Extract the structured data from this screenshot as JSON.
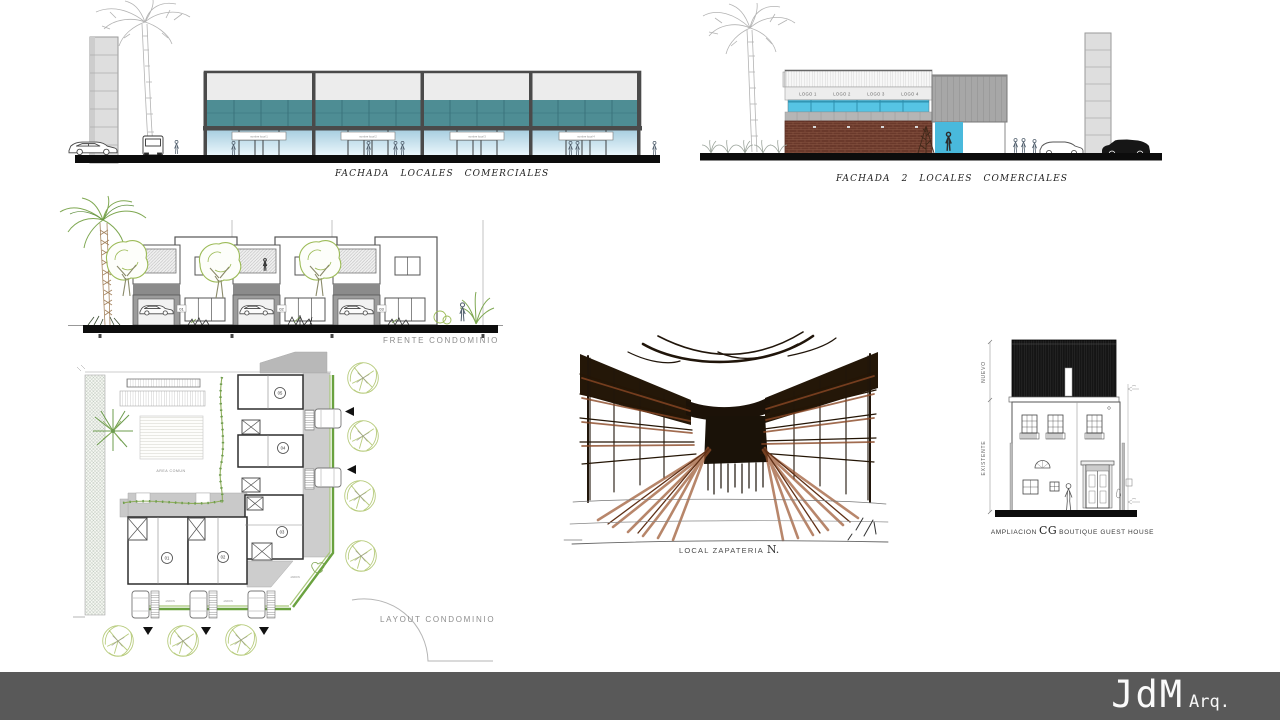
{
  "slide": {
    "footer": {
      "bar_color": "#595959",
      "brand": "JdM",
      "brand_suffix": "Arq."
    }
  },
  "fachada1": {
    "caption": "FACHADA  LOCALES  COMERCIALES",
    "signs": [
      "nombre local 1",
      "nombre local 2",
      "nombre local 3",
      "nombre local 4"
    ]
  },
  "fachada2": {
    "caption": "FACHADA 2  LOCALES  COMERCIALES",
    "logos": [
      "LOGO 1",
      "LOGO 2",
      "LOGO 3",
      "LOGO 4"
    ]
  },
  "frente": {
    "caption": "FRENTE  CONDOMINIO",
    "units": [
      "01",
      "02",
      "03"
    ]
  },
  "layout": {
    "caption": "LAYOUT  CONDOMINIO",
    "area_label": "AREA COMUN",
    "garden_label": "JARDIN",
    "units": [
      "01",
      "02",
      "03",
      "04",
      "05"
    ]
  },
  "zapateria": {
    "caption": "LOCAL ZAPATERIA",
    "caption_initial": "N."
  },
  "guesthouse": {
    "caption_prefix": "AMPLIACION",
    "caption_monogram": "CG",
    "caption_suffix": "BOUTIQUE GUEST HOUSE",
    "new_label": "NUEVO",
    "existing_label": "EXISTENTE"
  },
  "colors": {
    "teal_band": "#4e8d94",
    "storefront_blue": "#a9cfe0",
    "cyan_strip": "#56c4e4",
    "brick": "#6a392b",
    "panel_gray": "#a7a7a7",
    "tree_green": "#9cbb57",
    "hedge_green": "#6aa23f",
    "ink": "#20150a",
    "sepia": "#9a532c",
    "footer_gray": "#595959"
  }
}
